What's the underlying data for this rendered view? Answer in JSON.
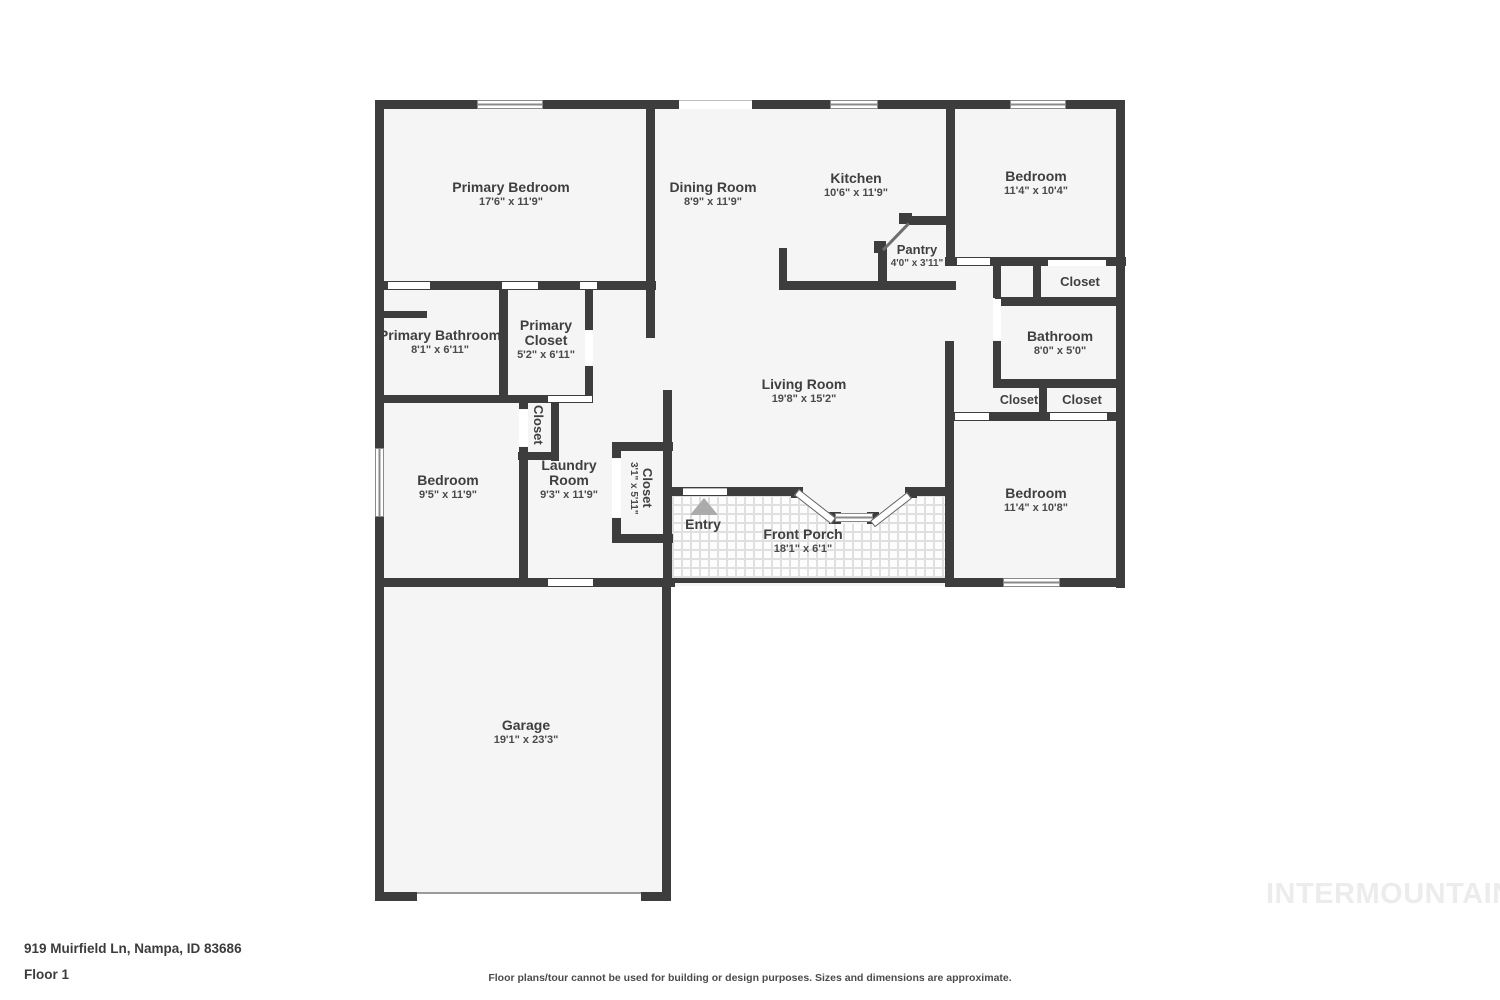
{
  "meta": {
    "address": "919 Muirfield Ln, Nampa, ID 83686",
    "floor_label": "Floor 1",
    "disclaimer": "Floor plans/tour cannot be used for building or design purposes. Sizes and dimensions are approximate.",
    "watermark": "INTERMOUNTAIN",
    "entry_marker": "up-triangle"
  },
  "colors": {
    "wall": "#3d3d3d",
    "room_fill": "#f5f5f6",
    "label_text": "#3f3f3f",
    "watermark_text": "#ececec",
    "entry_arrow": "#ababab"
  },
  "rooms": {
    "primary_bedroom": {
      "name": "Primary Bedroom",
      "dims": "17'6\" x 11'9\""
    },
    "dining_room": {
      "name": "Dining Room",
      "dims": "8'9\" x 11'9\""
    },
    "kitchen": {
      "name": "Kitchen",
      "dims": "10'6\" x 11'9\""
    },
    "bedroom_top_right": {
      "name": "Bedroom",
      "dims": "11'4\" x 10'4\""
    },
    "pantry": {
      "name": "Pantry",
      "dims": "4'0\" x 3'11\""
    },
    "closet_top_right": {
      "name": "Closet"
    },
    "primary_bathroom": {
      "name": "Primary Bathroom",
      "dims": "8'1\" x 6'11\""
    },
    "primary_closet": {
      "name": "Primary Closet",
      "dims": "5'2\" x 6'11\""
    },
    "bathroom": {
      "name": "Bathroom",
      "dims": "8'0\" x 5'0\""
    },
    "closet_hall_left": {
      "name": "Closet"
    },
    "closet_hall_right": {
      "name": "Closet"
    },
    "living_room": {
      "name": "Living Room",
      "dims": "19'8\" x 15'2\""
    },
    "bedroom_left": {
      "name": "Bedroom",
      "dims": "9'5\" x 11'9\""
    },
    "laundry_room": {
      "name": "Laundry Room",
      "dims": "9'3\" x 11'9\""
    },
    "closet_bedroom_left": {
      "name": "Closet"
    },
    "closet_entry": {
      "name": "Closet",
      "dims": "3'1\" x 5'11\""
    },
    "entry": {
      "name": "Entry"
    },
    "front_porch": {
      "name": "Front Porch",
      "dims": "18'1\" x 6'1\""
    },
    "bedroom_bottom_right": {
      "name": "Bedroom",
      "dims": "11'4\" x 10'8\""
    },
    "garage": {
      "name": "Garage",
      "dims": "19'1\" x 23'3\""
    }
  }
}
